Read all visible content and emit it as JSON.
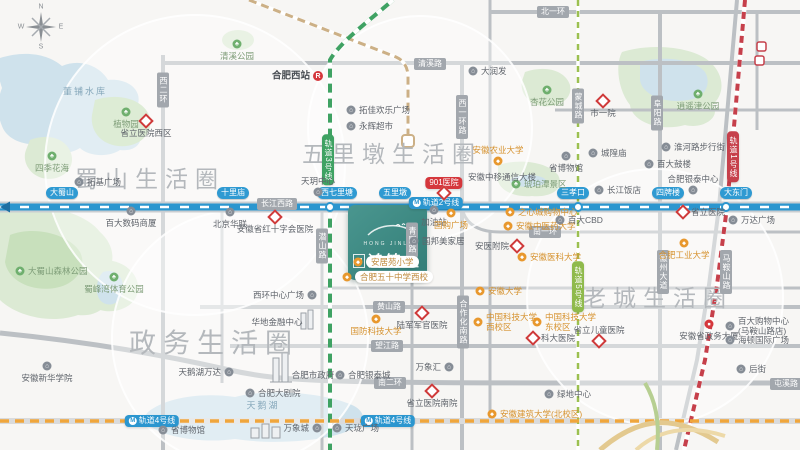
{
  "compass": {
    "n": "N",
    "e": "E",
    "s": "S",
    "w": "W"
  },
  "logo": {
    "latin": "HONG JINLI",
    "name": "鸿锦里"
  },
  "colors": {
    "brand_teal": "#3f8e88",
    "line1_red": "#c6404b",
    "line2_blue": "#2b96cf",
    "line3_green": "#3fa263",
    "line4_orange": "#f0a63c",
    "line5_yellowgreen": "#9cc050",
    "railway_tan": "#ccb086",
    "water": "#cfe2ec",
    "park": "#dcead4",
    "park_dark": "#c8e0bc",
    "road_gray": "#bcc0c4",
    "hospital_red": "#cf3a3a",
    "poi_orange": "#e8982e"
  },
  "districts": [
    {
      "t": "蜀山生活圈",
      "x": 150,
      "y": 177,
      "fs": 23
    },
    {
      "t": "五里墩生活圈",
      "x": 392,
      "y": 152,
      "fs": 23
    },
    {
      "t": "老城生活圈",
      "x": 658,
      "y": 296,
      "fs": 23
    },
    {
      "t": "政务生活圈",
      "x": 214,
      "y": 341,
      "fs": 27
    }
  ],
  "road_labels": [
    {
      "t": "北一环",
      "x": 553,
      "y": 12,
      "v": 0
    },
    {
      "t": "清溪路",
      "x": 430,
      "y": 64,
      "v": 0
    },
    {
      "t": "长江西路",
      "x": 277,
      "y": 204,
      "v": 0
    },
    {
      "t": "南一环",
      "x": 545,
      "y": 232,
      "v": 0
    },
    {
      "t": "黄山路",
      "x": 389,
      "y": 307,
      "v": 0
    },
    {
      "t": "望江路",
      "x": 387,
      "y": 346,
      "v": 0
    },
    {
      "t": "南二环",
      "x": 390,
      "y": 383,
      "v": 0
    },
    {
      "t": "屯溪路",
      "x": 786,
      "y": 384,
      "v": 0
    },
    {
      "t": "西二环",
      "x": 163,
      "y": 90,
      "v": 1
    },
    {
      "t": "西一环路",
      "x": 462,
      "y": 117,
      "v": 1
    },
    {
      "t": "青阳路",
      "x": 412,
      "y": 240,
      "v": 1
    },
    {
      "t": "合作化南路",
      "x": 463,
      "y": 322,
      "v": 1
    },
    {
      "t": "潜山路",
      "x": 322,
      "y": 246,
      "v": 1
    },
    {
      "t": "蒙城路",
      "x": 578,
      "y": 106,
      "v": 1
    },
    {
      "t": "阜阳路",
      "x": 657,
      "y": 113,
      "v": 1
    },
    {
      "t": "徽州大道",
      "x": 663,
      "y": 272,
      "v": 1
    },
    {
      "t": "马鞍山路",
      "x": 726,
      "y": 272,
      "v": 1
    }
  ],
  "metro": {
    "badges": [
      {
        "t": "轨道2号线",
        "x": 436,
        "y": 203,
        "c": "#2b96cf",
        "v": 0,
        "icon": 1
      },
      {
        "t": "轨道4号线",
        "x": 152,
        "y": 421,
        "c": "#2b96cf",
        "v": 0,
        "icon": 1
      },
      {
        "t": "轨道4号线",
        "x": 388,
        "y": 421,
        "c": "#2b96cf",
        "v": 0,
        "icon": 1
      },
      {
        "t": "901医院",
        "x": 444,
        "y": 183,
        "c": "#d5373c",
        "v": 0,
        "icon": 0
      },
      {
        "t": "轨道1号线",
        "x": 733,
        "y": 157,
        "c": "#c6404b",
        "v": 1,
        "icon": 0
      },
      {
        "t": "轨道3号线",
        "x": 328,
        "y": 160,
        "c": "#3fa263",
        "v": 1,
        "icon": 0
      },
      {
        "t": "轨道5号线",
        "x": 578,
        "y": 287,
        "c": "#8fba4c",
        "v": 1,
        "icon": 0
      }
    ],
    "line2_stations": [
      {
        "t": "大蜀山",
        "x": 62,
        "y": 193
      },
      {
        "t": "十里庙",
        "x": 233,
        "y": 193
      },
      {
        "t": "西七里塘",
        "x": 337,
        "y": 193
      },
      {
        "t": "五里墩",
        "x": 395,
        "y": 193
      },
      {
        "t": "三孝口",
        "x": 573,
        "y": 193
      },
      {
        "t": "四牌楼",
        "x": 668,
        "y": 193
      },
      {
        "t": "大东门",
        "x": 736,
        "y": 193
      }
    ]
  },
  "pois": [
    {
      "t": "清溪公园",
      "x": 237,
      "y": 44,
      "tp": "park",
      "s": "b"
    },
    {
      "t": "合肥西站",
      "x": 318,
      "y": 76,
      "tp": "rail",
      "s": "l"
    },
    {
      "t": "拓佳欢乐广场",
      "x": 351,
      "y": 110,
      "tp": "gray",
      "s": "r"
    },
    {
      "t": "永辉超市",
      "x": 351,
      "y": 126,
      "tp": "gray",
      "s": "r"
    },
    {
      "t": "大润发",
      "x": 473,
      "y": 71,
      "tp": "gray",
      "s": "r"
    },
    {
      "t": "市一院",
      "x": 603,
      "y": 101,
      "tp": "hospital",
      "s": "b"
    },
    {
      "t": "杏花公园",
      "x": 547,
      "y": 90,
      "tp": "park",
      "s": "b"
    },
    {
      "t": "逍遥津公园",
      "x": 698,
      "y": 94,
      "tp": "park",
      "s": "b"
    },
    {
      "t": "淮河路步行街",
      "x": 666,
      "y": 147,
      "tp": "gray",
      "s": "r"
    },
    {
      "t": "百大鼓楼",
      "x": 649,
      "y": 164,
      "tp": "gray",
      "s": "r"
    },
    {
      "t": "合肥银泰中心",
      "x": 693,
      "y": 190,
      "tp": "gray",
      "s": "a"
    },
    {
      "t": "长江饭店",
      "x": 599,
      "y": 190,
      "tp": "gray",
      "s": "r"
    },
    {
      "t": "城隍庙",
      "x": 593,
      "y": 153,
      "tp": "gray",
      "s": "r"
    },
    {
      "t": "省博物馆",
      "x": 566,
      "y": 156,
      "tp": "gray",
      "s": "b"
    },
    {
      "t": "琥珀潭景区",
      "x": 516,
      "y": 184,
      "tp": "park",
      "s": "r"
    },
    {
      "t": "安徽中移通信大楼",
      "x": 502,
      "y": 177,
      "tp": "plain",
      "s": "c"
    },
    {
      "t": "四季花海",
      "x": 52,
      "y": 156,
      "tp": "park",
      "s": "b"
    },
    {
      "t": "植物园",
      "x": 126,
      "y": 112,
      "tp": "park",
      "s": "b"
    },
    {
      "t": "省立医院西区",
      "x": 146,
      "y": 121,
      "tp": "hospital",
      "s": "b"
    },
    {
      "t": "拓基广场",
      "x": 79,
      "y": 182,
      "tp": "gray",
      "s": "r"
    },
    {
      "t": "百大数码商厦",
      "x": 131,
      "y": 211,
      "tp": "gray",
      "s": "b"
    },
    {
      "t": "北京华联",
      "x": 230,
      "y": 212,
      "tp": "gray",
      "s": "b"
    },
    {
      "t": "安徽省红十字会医院",
      "x": 275,
      "y": 217,
      "tp": "hospital",
      "s": "b"
    },
    {
      "t": "天玥中心",
      "x": 318,
      "y": 192,
      "tp": "gray",
      "s": "a"
    },
    {
      "t": "大蜀山森林公园",
      "x": 20,
      "y": 271,
      "tp": "park",
      "s": "r"
    },
    {
      "t": "蜀峰湾体育公园",
      "x": 114,
      "y": 277,
      "tp": "park",
      "s": "b"
    },
    {
      "t": "安徽农业大学",
      "x": 498,
      "y": 161,
      "tp": "orange",
      "s": "a"
    },
    {
      "t": "加油站",
      "x": 434,
      "y": 210,
      "tp": "gray",
      "s": "b"
    },
    {
      "t": "国购广场",
      "x": 451,
      "y": 213,
      "tp": "orange",
      "s": "b"
    },
    {
      "t": "之心城购物中心",
      "x": 510,
      "y": 212,
      "tp": "orange",
      "s": "r"
    },
    {
      "t": "安徽中医药大学",
      "x": 508,
      "y": 226,
      "tp": "orange",
      "s": "r"
    },
    {
      "t": "百大CBD",
      "x": 560,
      "y": 220,
      "tp": "gray",
      "s": "r"
    },
    {
      "t": "国邦美家居",
      "x": 414,
      "y": 241,
      "tp": "gray",
      "s": "r"
    },
    {
      "t": "安医附院",
      "x": 517,
      "y": 246,
      "tp": "hospital",
      "s": "l"
    },
    {
      "t": "安徽医科大学",
      "x": 522,
      "y": 257,
      "tp": "orange",
      "s": "r"
    },
    {
      "t": "安徽大学",
      "x": 480,
      "y": 291,
      "tp": "orange",
      "s": "r"
    },
    {
      "t": "中国科技大学\n西校区",
      "x": 478,
      "y": 322,
      "tp": "orange",
      "s": "r"
    },
    {
      "t": "中国科技大学\n东校区",
      "x": 537,
      "y": 322,
      "tp": "orange",
      "s": "r"
    },
    {
      "t": "科大医院",
      "x": 533,
      "y": 338,
      "tp": "hospital",
      "s": "r"
    },
    {
      "t": "省立儿童医院",
      "x": 599,
      "y": 341,
      "tp": "hospital",
      "s": "a"
    },
    {
      "t": "万象汇",
      "x": 449,
      "y": 367,
      "tp": "gray",
      "s": "l"
    },
    {
      "t": "省立医院南院",
      "x": 432,
      "y": 391,
      "tp": "hospital",
      "s": "b"
    },
    {
      "t": "绿地中心",
      "x": 549,
      "y": 394,
      "tp": "gray",
      "s": "r"
    },
    {
      "t": "安徽建筑大学(北校区)",
      "x": 492,
      "y": 414,
      "tp": "orange",
      "s": "r"
    },
    {
      "t": "合肥工业大学",
      "x": 684,
      "y": 243,
      "tp": "orange",
      "s": "b"
    },
    {
      "t": "万达广场",
      "x": 733,
      "y": 220,
      "tp": "gray",
      "s": "r"
    },
    {
      "t": "省立医院",
      "x": 683,
      "y": 212,
      "tp": "hospital",
      "s": "r"
    },
    {
      "t": "安徽省政务大厦",
      "x": 709,
      "y": 324,
      "tp": "govt",
      "s": "b"
    },
    {
      "t": "百大购物中心\n(马鞍山路店)",
      "x": 730,
      "y": 326,
      "tp": "gray",
      "s": "r"
    },
    {
      "t": "海顿国际广场",
      "x": 730,
      "y": 340,
      "tp": "gray",
      "s": "r"
    },
    {
      "t": "后街",
      "x": 741,
      "y": 369,
      "tp": "gray",
      "s": "r"
    },
    {
      "t": "天珑广场",
      "x": 337,
      "y": 428,
      "tp": "gray",
      "s": "r"
    },
    {
      "t": "万象城",
      "x": 317,
      "y": 428,
      "tp": "gray",
      "s": "l"
    },
    {
      "t": "省博物馆",
      "x": 163,
      "y": 430,
      "tp": "gray",
      "s": "r"
    },
    {
      "t": "天鹅湖万达",
      "x": 229,
      "y": 372,
      "tp": "gray",
      "s": "l"
    },
    {
      "t": "合肥市政府",
      "x": 313,
      "y": 375,
      "tp": "plain",
      "s": "c"
    },
    {
      "t": "合肥银泰城",
      "x": 340,
      "y": 375,
      "tp": "gray",
      "s": "r"
    },
    {
      "t": "合肥大剧院",
      "x": 250,
      "y": 393,
      "tp": "gray",
      "s": "r"
    },
    {
      "t": "华地金融中心",
      "x": 277,
      "y": 322,
      "tp": "plain",
      "s": "c"
    },
    {
      "t": "国防科技大学",
      "x": 376,
      "y": 319,
      "tp": "orange",
      "s": "b"
    },
    {
      "t": "陆军军官医院",
      "x": 422,
      "y": 313,
      "tp": "hospital",
      "s": "b"
    },
    {
      "t": "安徽新华学院",
      "x": 47,
      "y": 366,
      "tp": "gray",
      "s": "b"
    },
    {
      "t": "西环中心广场",
      "x": 312,
      "y": 295,
      "tp": "gray",
      "s": "l"
    },
    {
      "t": "天鹅湖",
      "x": 263,
      "y": 406,
      "tp": "water",
      "s": "c"
    },
    {
      "t": "董铺水库",
      "x": 85,
      "y": 92,
      "tp": "water",
      "s": "c"
    },
    {
      "t": "安居苑小学",
      "x": 358,
      "y": 262,
      "tp": "school",
      "s": "r"
    },
    {
      "t": "合肥五十中学西校",
      "x": 347,
      "y": 277,
      "tp": "school",
      "s": "r"
    },
    {
      "t": "",
      "x": 444,
      "y": 193,
      "tp": "hospital",
      "s": "r"
    }
  ]
}
